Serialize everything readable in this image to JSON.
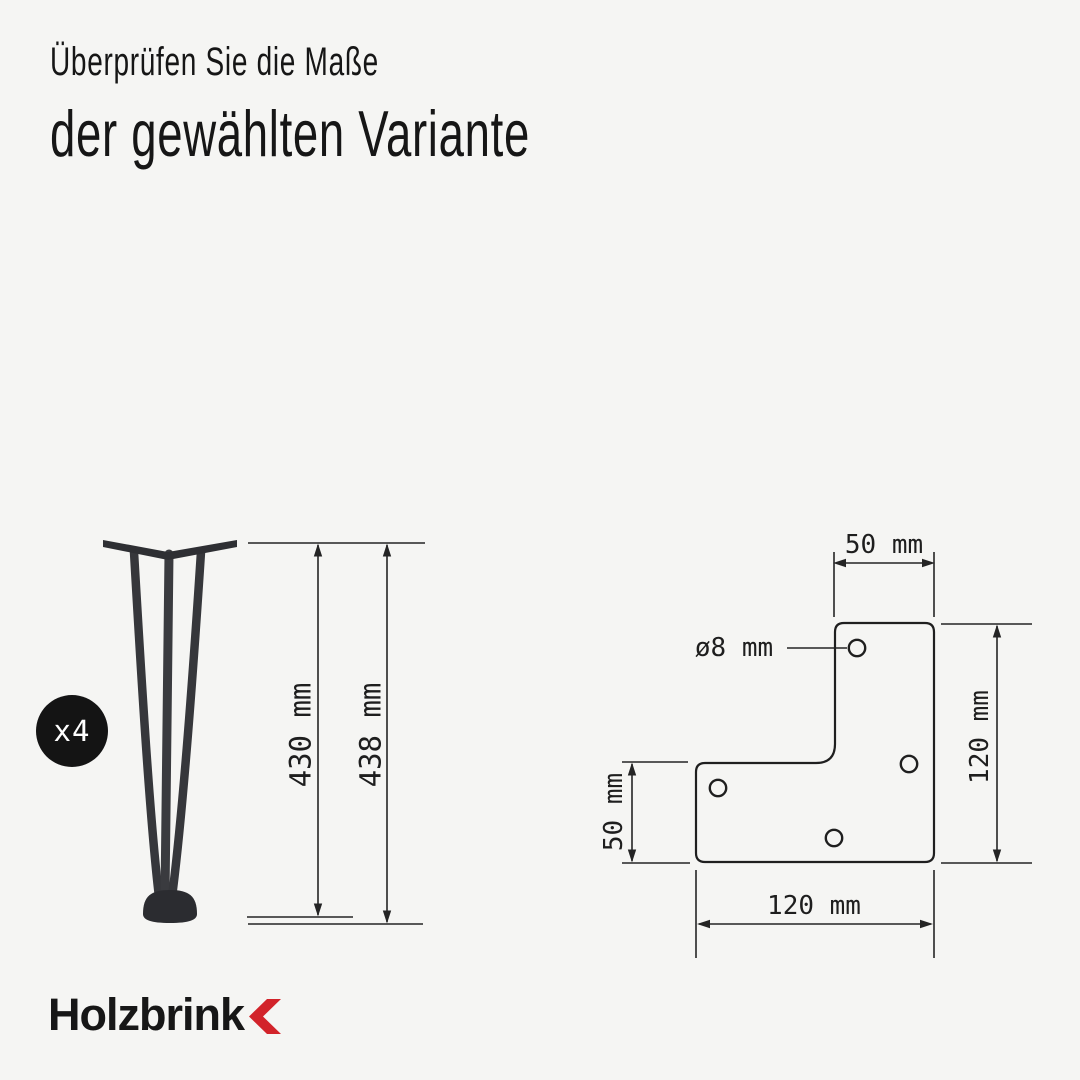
{
  "title": {
    "line1": "Überprüfen Sie die Maße",
    "line2": "der gewählten Variante"
  },
  "badge": {
    "label": "x4"
  },
  "leg_diagram": {
    "height_without_foot": "430 mm",
    "height_with_foot": "438 mm"
  },
  "plate_diagram": {
    "top_arm_width": "50 mm",
    "hole_diameter": "ø8 mm",
    "left_arm_height": "50 mm",
    "side_height": "120 mm",
    "bottom_width": "120 mm",
    "hole_count": 4
  },
  "brand": {
    "name": "Holzbrink"
  },
  "colors": {
    "background": "#f5f5f3",
    "ink": "#161616",
    "drawing_line": "#242424",
    "leg_metal": "#36373b",
    "badge_background": "#141414",
    "brand_red": "#d2232a"
  }
}
